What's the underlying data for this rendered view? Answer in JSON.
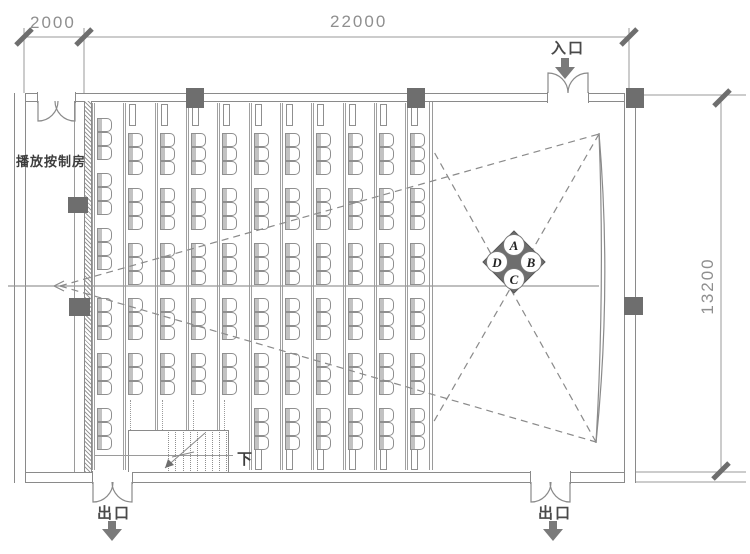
{
  "drawing": {
    "type": "auditorium-floor-plan",
    "dimensions": {
      "control_room_width": "2000",
      "hall_width": "22000",
      "hall_depth": "13200"
    },
    "labels": {
      "control_room": "播放按制房",
      "entrance": "入口",
      "exit_left": "出口",
      "exit_right": "出口",
      "stair_down": "下"
    },
    "zone_marker": {
      "top": "A",
      "right": "B",
      "bottom": "C",
      "left": "D"
    },
    "colors": {
      "wall_line": "#8a8a8a",
      "dark_fill": "#6e6e6e",
      "label_text": "#3d3d3d",
      "dimension_text": "#8f8f8f"
    }
  },
  "seating": {
    "seat_w": 15,
    "seat_h": 14,
    "seats_per_group": 3,
    "group_pitch": 55,
    "rows": [
      {
        "x": 97,
        "groups_y": [
          118,
          173,
          228,
          298,
          353,
          408
        ]
      },
      {
        "x": 128,
        "groups_y": [
          133,
          188,
          243,
          298,
          353
        ]
      },
      {
        "x": 160,
        "groups_y": [
          133,
          188,
          243,
          298,
          353
        ]
      },
      {
        "x": 191,
        "groups_y": [
          133,
          188,
          243,
          298,
          353
        ]
      },
      {
        "x": 222,
        "groups_y": [
          133,
          188,
          243,
          298,
          353
        ]
      },
      {
        "x": 254,
        "groups_y": [
          133,
          188,
          243,
          298,
          353,
          408
        ]
      },
      {
        "x": 285,
        "groups_y": [
          133,
          188,
          243,
          298,
          353,
          408
        ]
      },
      {
        "x": 316,
        "groups_y": [
          133,
          188,
          243,
          298,
          353,
          408
        ]
      },
      {
        "x": 348,
        "groups_y": [
          133,
          188,
          243,
          298,
          353,
          408
        ]
      },
      {
        "x": 379,
        "groups_y": [
          133,
          188,
          243,
          298,
          353,
          408
        ]
      },
      {
        "x": 410,
        "groups_y": [
          133,
          188,
          243,
          298,
          353,
          408
        ]
      }
    ],
    "total_seats": 186
  }
}
